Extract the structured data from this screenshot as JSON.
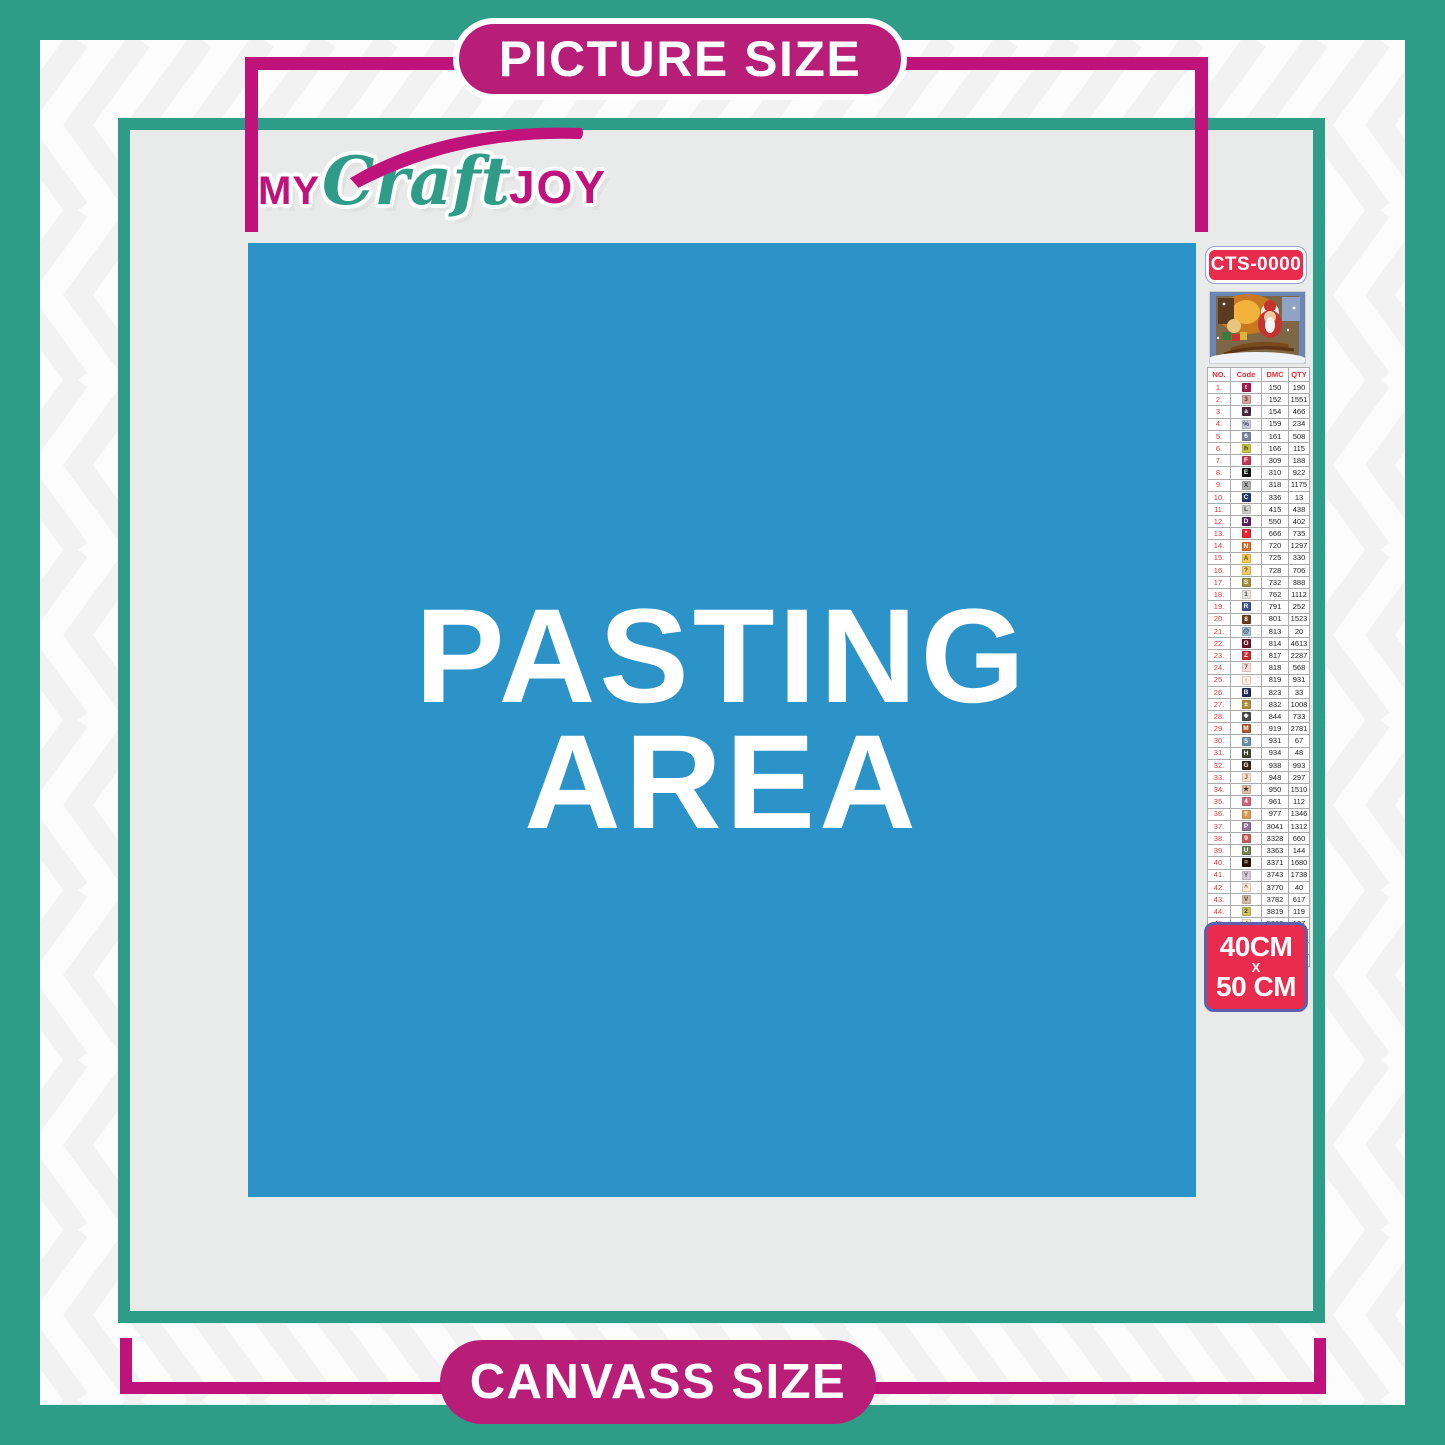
{
  "labels": {
    "picture_size": "PICTURE SIZE",
    "canvass_size": "CANVASS SIZE"
  },
  "logo": {
    "my": "MY",
    "craft": "Craft",
    "joy": "JOY"
  },
  "pasting_area": {
    "line1": "PASTING",
    "line2": "AREA"
  },
  "product": {
    "code": "CTS-0000",
    "size_width": "40CM",
    "size_sep": "X",
    "size_height": "50 CM",
    "preview": "christmas-santa-on-sleigh-artwork"
  },
  "color_chart": {
    "type": "table",
    "headers": [
      "NO.",
      "Code",
      "DMC",
      "QTY"
    ],
    "rows": [
      {
        "no": "1.",
        "sym": "t",
        "bg": "#A91C4E",
        "fg": "#FFFFFF",
        "dmc": "150",
        "qty": "190"
      },
      {
        "no": "2.",
        "sym": "3",
        "bg": "#DCA3A3",
        "fg": "#443333",
        "dmc": "152",
        "qty": "1551"
      },
      {
        "no": "3.",
        "sym": "a",
        "bg": "#4A2A3A",
        "fg": "#FFFFFF",
        "dmc": "154",
        "qty": "466"
      },
      {
        "no": "4.",
        "sym": "%",
        "bg": "#C9CBD8",
        "fg": "#444455",
        "dmc": "159",
        "qty": "234"
      },
      {
        "no": "5.",
        "sym": "6",
        "bg": "#7C86A0",
        "fg": "#FFFFFF",
        "dmc": "161",
        "qty": "508"
      },
      {
        "no": "6.",
        "sym": "h",
        "bg": "#BFC742",
        "fg": "#333311",
        "dmc": "166",
        "qty": "115"
      },
      {
        "no": "7.",
        "sym": "F",
        "bg": "#C13A55",
        "fg": "#FFFFFF",
        "dmc": "309",
        "qty": "188"
      },
      {
        "no": "8.",
        "sym": "E",
        "bg": "#111111",
        "fg": "#FFFFFF",
        "dmc": "310",
        "qty": "922"
      },
      {
        "no": "9.",
        "sym": "X",
        "bg": "#B3B3B3",
        "fg": "#333333",
        "dmc": "318",
        "qty": "1175"
      },
      {
        "no": "10.",
        "sym": "C",
        "bg": "#2A3C6E",
        "fg": "#FFFFFF",
        "dmc": "336",
        "qty": "13"
      },
      {
        "no": "11.",
        "sym": "L",
        "bg": "#CFCFCB",
        "fg": "#444444",
        "dmc": "415",
        "qty": "438"
      },
      {
        "no": "12.",
        "sym": "D",
        "bg": "#5B2260",
        "fg": "#FFFFFF",
        "dmc": "550",
        "qty": "402"
      },
      {
        "no": "13.",
        "sym": "*",
        "bg": "#E32636",
        "fg": "#FFFFFF",
        "dmc": "666",
        "qty": "735"
      },
      {
        "no": "14.",
        "sym": "N",
        "bg": "#DD6F2B",
        "fg": "#FFFFFF",
        "dmc": "720",
        "qty": "1297"
      },
      {
        "no": "15.",
        "sym": "A",
        "bg": "#F4C94F",
        "fg": "#5A4A00",
        "dmc": "725",
        "qty": "330"
      },
      {
        "no": "16.",
        "sym": "?",
        "bg": "#EFC96E",
        "fg": "#5A4A00",
        "dmc": "728",
        "qty": "706"
      },
      {
        "no": "17.",
        "sym": "S",
        "bg": "#9A9138",
        "fg": "#FFFFFF",
        "dmc": "732",
        "qty": "388"
      },
      {
        "no": "18.",
        "sym": "1",
        "bg": "#E8E3DF",
        "fg": "#444444",
        "dmc": "762",
        "qty": "1112"
      },
      {
        "no": "19.",
        "sym": "R",
        "bg": "#41518F",
        "fg": "#FFFFFF",
        "dmc": "791",
        "qty": "252"
      },
      {
        "no": "20.",
        "sym": "8",
        "bg": "#6C3D1E",
        "fg": "#FFFFFF",
        "dmc": "801",
        "qty": "1523"
      },
      {
        "no": "21.",
        "sym": "@",
        "bg": "#A5C3DA",
        "fg": "#333344",
        "dmc": "813",
        "qty": "20"
      },
      {
        "no": "22.",
        "sym": "O",
        "bg": "#6E1226",
        "fg": "#FFFFFF",
        "dmc": "814",
        "qty": "4613"
      },
      {
        "no": "23.",
        "sym": "Z",
        "bg": "#CC2B2F",
        "fg": "#FFFFFF",
        "dmc": "817",
        "qty": "2287"
      },
      {
        "no": "24.",
        "sym": "7",
        "bg": "#F8DCD8",
        "fg": "#555555",
        "dmc": "818",
        "qty": "568"
      },
      {
        "no": "25.",
        "sym": "↑",
        "bg": "#FAEAE6",
        "fg": "#555555",
        "dmc": "819",
        "qty": "931"
      },
      {
        "no": "26.",
        "sym": "B",
        "bg": "#1F2C5C",
        "fg": "#FFFFFF",
        "dmc": "823",
        "qty": "33"
      },
      {
        "no": "27.",
        "sym": "±",
        "bg": "#AD9139",
        "fg": "#FFFFFF",
        "dmc": "832",
        "qty": "1008"
      },
      {
        "no": "28.",
        "sym": "❖",
        "bg": "#4C4C4C",
        "fg": "#FFFFFF",
        "dmc": "844",
        "qty": "733"
      },
      {
        "no": "29.",
        "sym": "M",
        "bg": "#AC5730",
        "fg": "#FFFFFF",
        "dmc": "919",
        "qty": "2781"
      },
      {
        "no": "30.",
        "sym": "5",
        "bg": "#6E8FAC",
        "fg": "#FFFFFF",
        "dmc": "931",
        "qty": "67"
      },
      {
        "no": "31.",
        "sym": "H",
        "bg": "#3E4530",
        "fg": "#FFFFFF",
        "dmc": "934",
        "qty": "48"
      },
      {
        "no": "32.",
        "sym": "G",
        "bg": "#3A2413",
        "fg": "#FFFFFF",
        "dmc": "938",
        "qty": "993"
      },
      {
        "no": "33.",
        "sym": "J",
        "bg": "#F8DECE",
        "fg": "#666655",
        "dmc": "948",
        "qty": "297"
      },
      {
        "no": "34.",
        "sym": "★",
        "bg": "#E2BFA8",
        "fg": "#443322",
        "dmc": "950",
        "qty": "1510"
      },
      {
        "no": "35.",
        "sym": "4",
        "bg": "#C9677B",
        "fg": "#FFFFFF",
        "dmc": "961",
        "qty": "112"
      },
      {
        "no": "36.",
        "sym": "T",
        "bg": "#DB9B51",
        "fg": "#FFFFFF",
        "dmc": "977",
        "qty": "1346"
      },
      {
        "no": "37.",
        "sym": "P",
        "bg": "#91709A",
        "fg": "#FFFFFF",
        "dmc": "3041",
        "qty": "1312"
      },
      {
        "no": "38.",
        "sym": "9",
        "bg": "#C75D5D",
        "fg": "#FFFFFF",
        "dmc": "3328",
        "qty": "660"
      },
      {
        "no": "39.",
        "sym": "U",
        "bg": "#70834F",
        "fg": "#FFFFFF",
        "dmc": "3363",
        "qty": "144"
      },
      {
        "no": "40.",
        "sym": "=",
        "bg": "#241409",
        "fg": "#FFFFFF",
        "dmc": "3371",
        "qty": "1680"
      },
      {
        "no": "41.",
        "sym": "Y",
        "bg": "#D6CBD6",
        "fg": "#555555",
        "dmc": "3743",
        "qty": "1738"
      },
      {
        "no": "42.",
        "sym": "^",
        "bg": "#F6E8D4",
        "fg": "#555544",
        "dmc": "3770",
        "qty": "40"
      },
      {
        "no": "43.",
        "sym": "V",
        "bg": "#D3BDA5",
        "fg": "#554433",
        "dmc": "3782",
        "qty": "617"
      },
      {
        "no": "44.",
        "sym": "2",
        "bg": "#C9C460",
        "fg": "#444422",
        "dmc": "3819",
        "qty": "119"
      },
      {
        "no": "45.",
        "sym": "✓",
        "bg": "#FAF0CC",
        "fg": "#555533",
        "dmc": "3823",
        "qty": "107"
      },
      {
        "no": "46.",
        "sym": "C",
        "bg": "#E8913D",
        "fg": "#FFFFFF",
        "dmc": "3853",
        "qty": "1332"
      },
      {
        "no": "47.",
        "sym": "K",
        "bg": "#7E433B",
        "fg": "#FFFFFF",
        "dmc": "3858",
        "qty": "2311"
      },
      {
        "no": "48.",
        "sym": "A",
        "bg": "#9B785E",
        "fg": "#FFFFFF",
        "dmc": "3863",
        "qty": "1820"
      }
    ]
  },
  "colors": {
    "teal": "#2F9C88",
    "magenta": "#C0127B",
    "pill_magenta": "#B81E78",
    "pasting_blue": "#2B93C7",
    "canvas_gray": "#E9EAEA",
    "badge_red": "#E92B4D",
    "badge_border_blue": "#5A62B0",
    "table_header_red": "#E02B35"
  }
}
